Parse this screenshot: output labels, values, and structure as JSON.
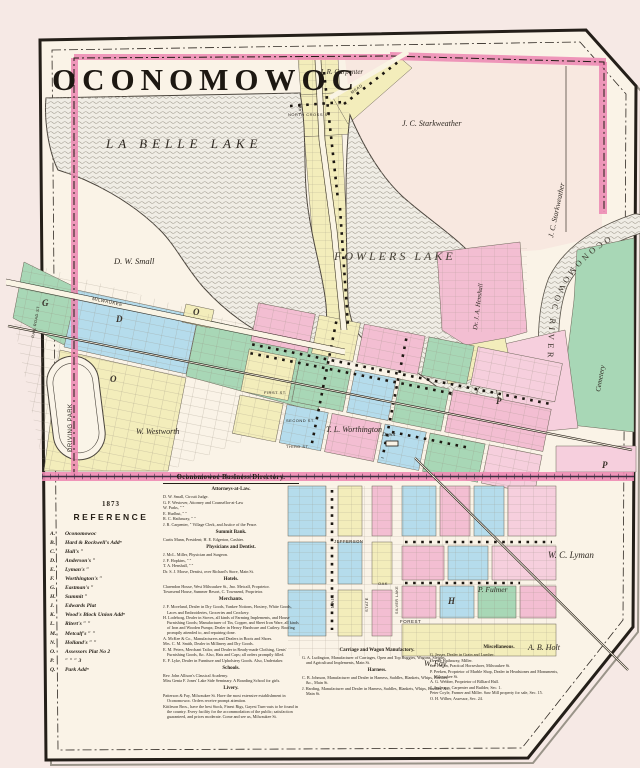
{
  "map": {
    "title": "OCONOMOWOC",
    "labels": {
      "la_belle_lake": "LA BELLE LAKE",
      "fowlers_lake": "FOWLERS LAKE",
      "oconomowoc_river": "OCONOMOWOC RIVER",
      "carpenter": "J. R. Carpenter",
      "starkweather": "J. C. Starkweather",
      "starkweather_east": "J. C. Starkweather",
      "henshall": "Dr. J. A. Henshall",
      "cemetery": "Cemetery",
      "small": "D. W. Small",
      "driving_park": "DRIVING PARK",
      "westworth": "W. Westworth",
      "worthington": "T. L. Worthington",
      "lyman": "W. C. Lyman",
      "fulmer": "P. Fulmer",
      "holt": "A. B. Holt",
      "fay": "W. Fay",
      "depot": "Depot",
      "milwaukee_road": "MILWAUKEE",
      "rail_road_st": "RAIL ROAD ST",
      "north_cross_st": "NORTH CROSS ST",
      "mead_road": "MEAD",
      "lake_st": "LAKE",
      "first_st": "FIRST ST.",
      "second_st": "SECOND ST.",
      "third_st": "THIRD ST.",
      "main_st": "MAIN",
      "state_st": "STATE",
      "oak_st": "OAK",
      "forest_st": "FOREST",
      "silver_lake_st": "SILVER LAKE",
      "jefferson_st": "JEFFERSON",
      "plat_g": "G",
      "plat_d": "D",
      "plat_o": "O",
      "plat_o2": "O",
      "plat_p": "P",
      "plat_p2": "P",
      "plat_h": "H"
    },
    "colors": {
      "plat_pink": "#f3bed2",
      "plat_blue": "#b5dcec",
      "plat_green": "#a8d7b6",
      "plat_yellow": "#f3edbb",
      "boundary_pink": "#ec86b1",
      "railroad_band": "#ee8bb4",
      "paper": "#faf3e7",
      "lake": "#f0ede5"
    }
  },
  "reference": {
    "year": "1873",
    "heading": "REFERENCE",
    "items": [
      {
        "key": "A.",
        "label": "Oconomowoc"
      },
      {
        "key": "B.",
        "label": "Hard & Rockwell's  Addⁿ"
      },
      {
        "key": "C.",
        "label": "Hall's  ″"
      },
      {
        "key": "D.",
        "label": "Anderson's  ″"
      },
      {
        "key": "E.",
        "label": "Lyman's  ″"
      },
      {
        "key": "F.",
        "label": "Worthington's  ″"
      },
      {
        "key": "G.",
        "label": "Eastman's  ″"
      },
      {
        "key": "H.",
        "label": "Summit  ″"
      },
      {
        "key": "J.",
        "label": "Edwards Plat"
      },
      {
        "key": "K.",
        "label": "Wood's Block Union  Addⁿ"
      },
      {
        "key": "L.",
        "label": "Ritert's  ″  ″"
      },
      {
        "key": "M.",
        "label": "Metcalf's  ″  ″"
      },
      {
        "key": "N.",
        "label": "Holland's  ″  ″"
      },
      {
        "key": "O.",
        "label": "Assessors Plat  No 2"
      },
      {
        "key": "P.",
        "label": "″  ″  ″  3"
      },
      {
        "key": "Q.",
        "label": "Park Addⁿ"
      }
    ]
  },
  "directory": {
    "title": "Oconomowoc Business Directory.",
    "attorneys": {
      "heading": "Attorneys-at-Law.",
      "entries": [
        "D. W. Small, Circuit Judge.",
        "G. F. Westover, Attorney and Counsellor-at-Law",
        "W. Parks,   ″   ″",
        "E. Hurlbut,   ″   ″",
        "R. C. Hathaway,   ″   ″",
        "J. R. Carpenter,  ″  Village Clerk, and Justice of the Peace."
      ]
    },
    "bank": {
      "heading": "Summit Bank.",
      "entries": [
        "Curtis Mann, President; H. E. Edgerton, Cashier."
      ]
    },
    "physicians": {
      "heading": "Physicians and Dentist.",
      "entries": [
        "J. McL. Miller, Physician and Surgeon.",
        "J. F. Hopkins,   ″   ″",
        "T. A. Henshall,   ″   ″",
        "Dr. S. J. Morse, Dentist, over Richard's Store, Main St."
      ]
    },
    "hotels": {
      "heading": "Hotels.",
      "entries": [
        "Clarendon House, West Milwaukee St., Jno. Metcalf, Proprietor.",
        "Townsend House, Summer Resort, C. Townsend, Proprietor."
      ]
    },
    "merchants": {
      "heading": "Merchants.",
      "entries": [
        "J. F. Moreland, Dealer in Dry Goods, Yankee Notions, Hosiery, White Goods, Laces and Embroideries, Groceries and Crockery.",
        "H. Lodeborg, Dealer in Stoves, all kinds of Farming Implements, and House Furnishing Goods; Manufacturer of Tin, Copper, and Sheet Iron Ware, all kinds of Iron and Wooden Pumps; Dealer in Heavy Hardware and Cutlery. Roofing promptly attended to, and repairing done.",
        "A. McKee & Co., Manufacturers and Dealers in Boots and Shoes.",
        "Mrs. C. M. Smith, Dealer in Millinery and Dry Goods.",
        "E. M. Peters, Merchant Tailor, and Dealer in Ready-made Clothing, Gents' Furnishing Goods, &c. Also, Hats and Caps; all orders promptly filled.",
        "E. F. Lyke, Dealer in Furniture and Upholstery Goods. Also, Undertaker."
      ]
    },
    "schools": {
      "heading": "Schools.",
      "entries": [
        "Rev. John Allison's Classical Academy.",
        "Miss Genia F. Jones' Lake Side Seminary.  A Boarding School for girls."
      ]
    },
    "livery": {
      "heading": "Livery.",
      "entries": [
        "Patterson & Fay, Milwaukee St.  Have the most extensive establishment in Oconomowoc.  Orders receive prompt attention.",
        "Kittleson Bros., have the best Stock, Finest Rigs, Gayest Turn-outs to be found in the country.  Every facility for the accommodation of the public; satisfaction guaranteed, and prices moderate.  Come and see us, Milwaukee St."
      ]
    },
    "carriage": {
      "heading": "Carriage and Wagon Manufactory.",
      "entries": [
        "G. A. Ludington, Manufacturer of Carriages, Open and Top Buggies, Wagons, Sleighs, and Agricultural Implements, Main St."
      ]
    },
    "harness": {
      "heading": "Harness.",
      "entries": [
        "C. B. Johnson, Manufacturer and Dealer in Harness, Saddles, Blankets, Whips, Brushes, &c., Main St.",
        "J. Harding, Manufacturer and Dealer in Harness, Saddles, Blankets, Whips, Brushes, &c., Main St."
      ]
    },
    "misc": {
      "heading": "Miscellaneous.",
      "entries": [
        "G. Jesser, Dealer in Grain and Lumber.",
        "Orville Hathaway, Miller.",
        "Jas. Fallon, Practical Horseshoer, Milwaukee St.",
        "P. Peeken, Proprietor of Marble Shop, Dealer in Headstones and Monuments, Milwaukee St.",
        "A. G. Webber, Proprietor of Billiard Hall.",
        "J. Anderson, Carpenter and Builder, Sec. 1.",
        "Peter Coyle, Farmer and Miller.  Saw Mill property for sale, Sec. 15.",
        "O. H. Wilber, Assessor, Sec. 24."
      ]
    }
  }
}
